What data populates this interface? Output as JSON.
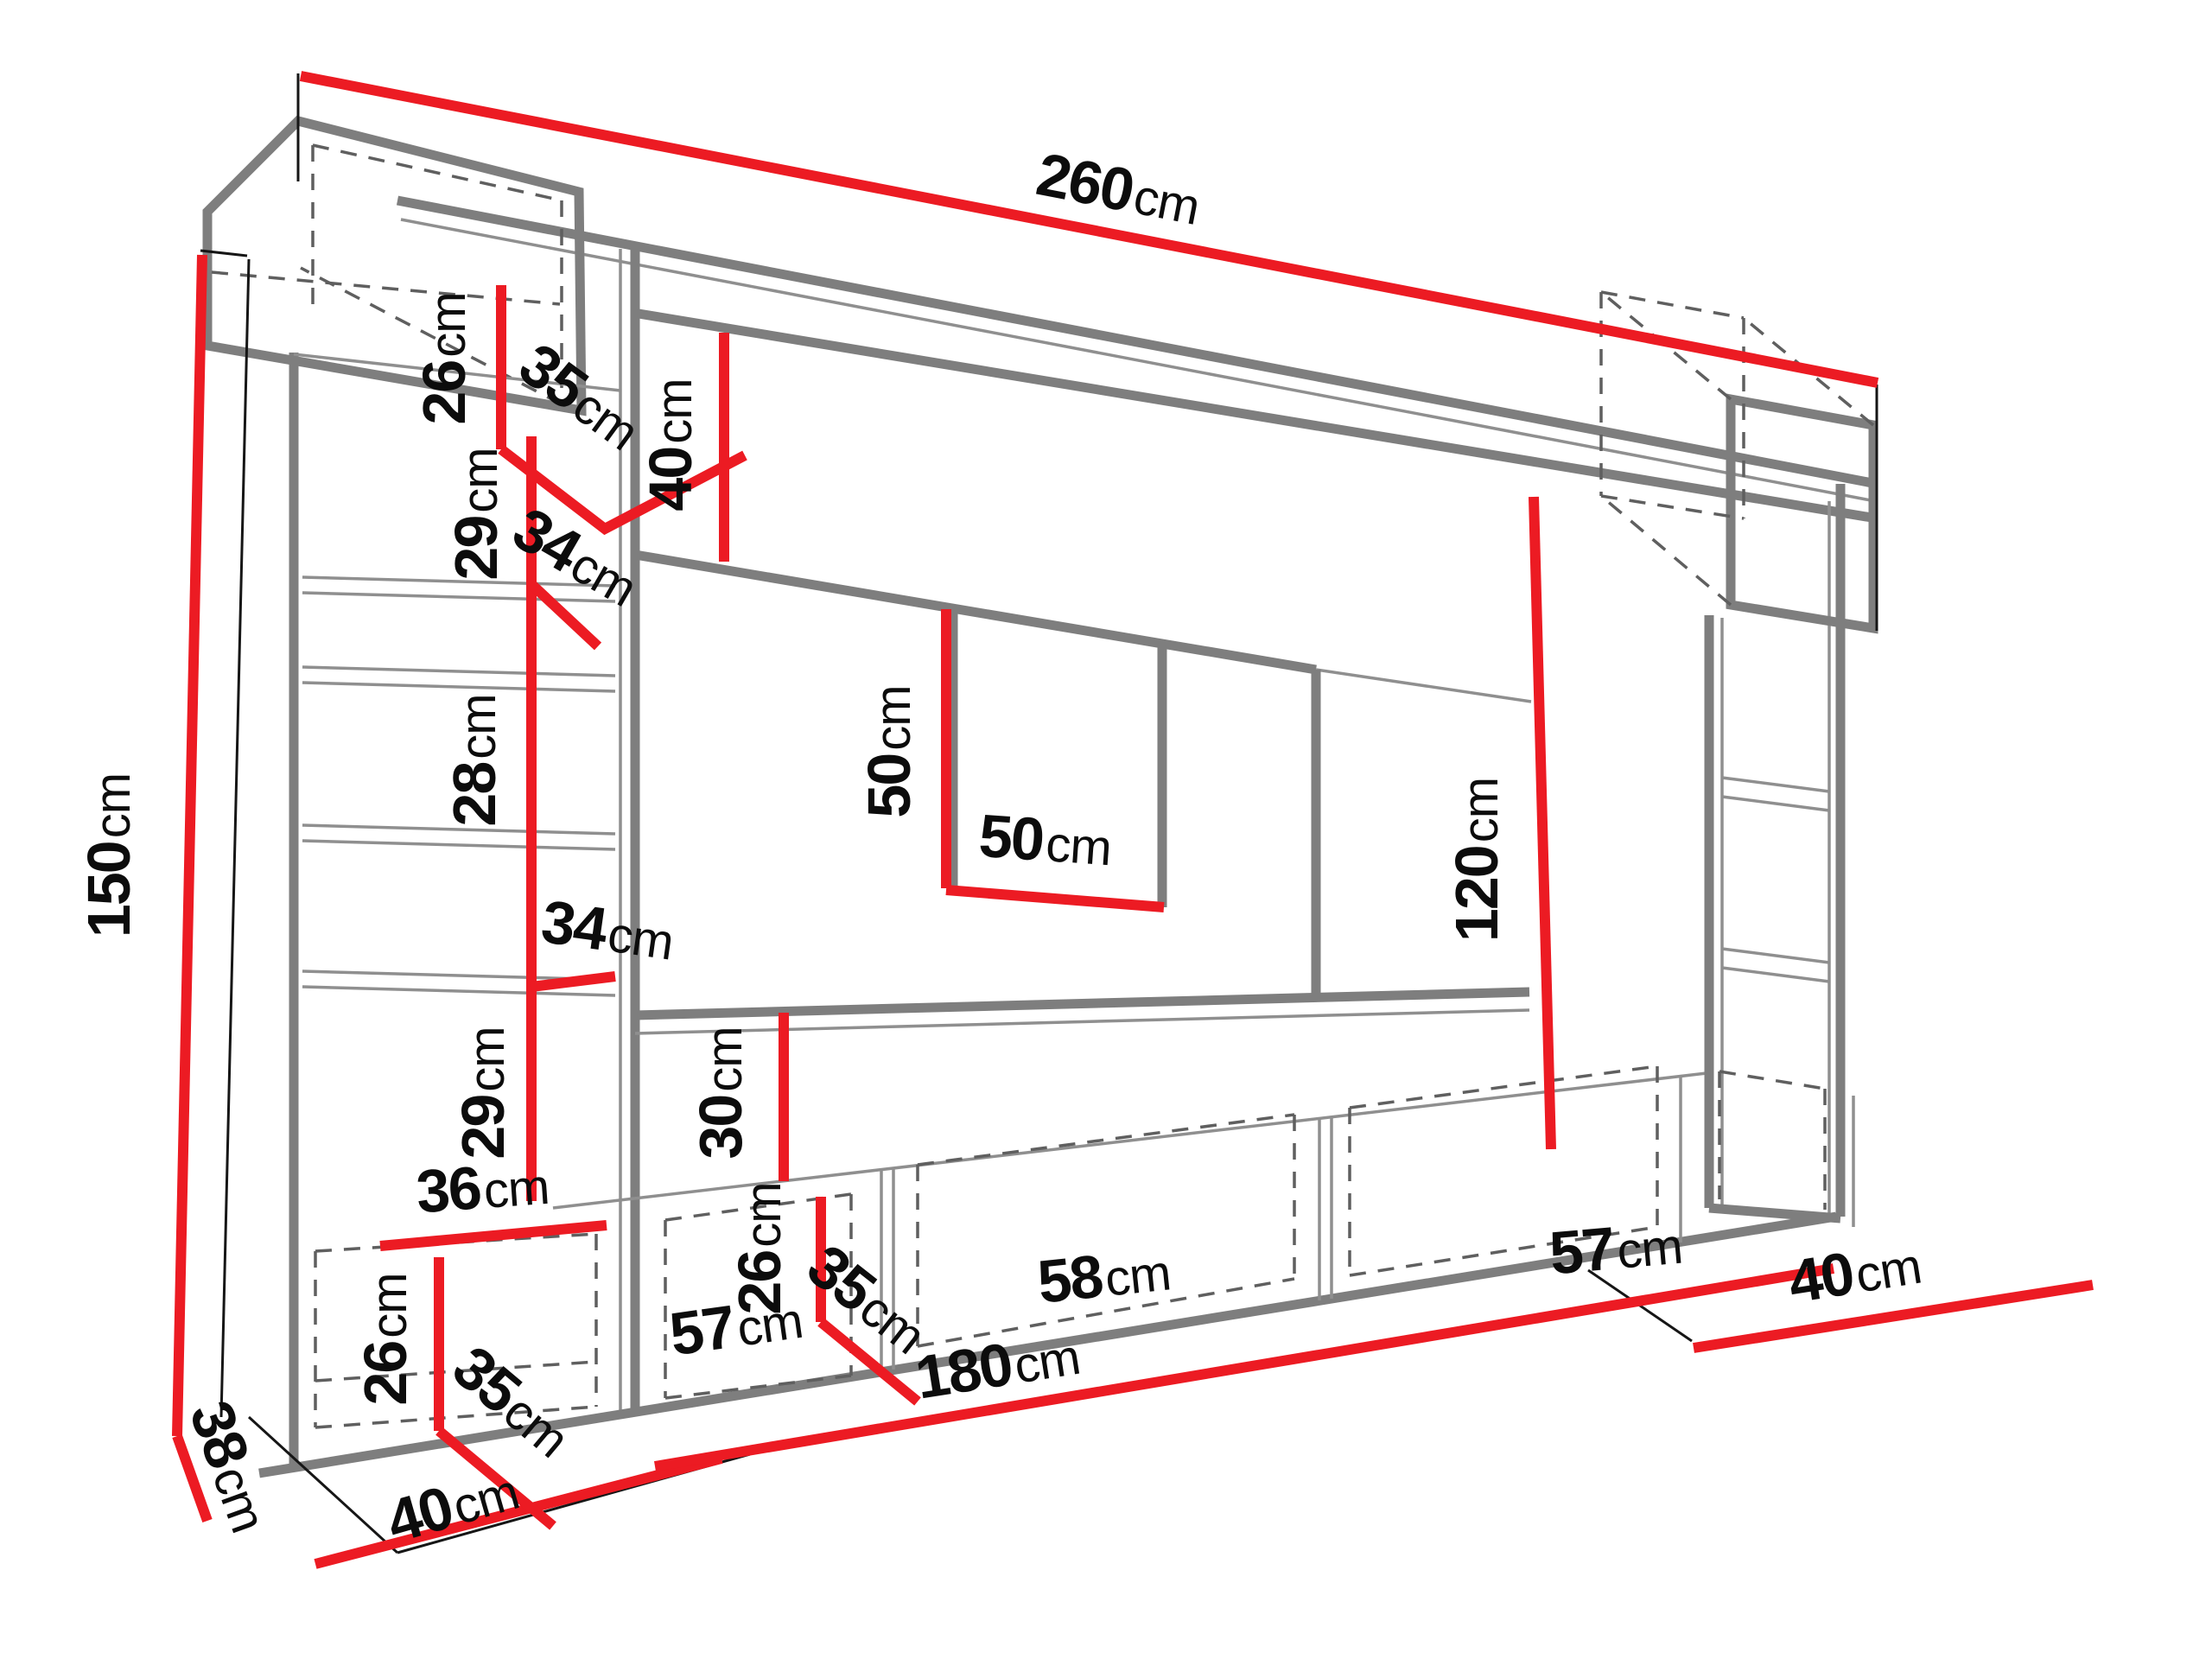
{
  "diagram": {
    "kind": "furniture dimension drawing",
    "unit_suffix": "cm",
    "colors": {
      "dimension_line": "#ec1b23",
      "furniture_line": "#7e7e7e",
      "hidden_line": "#5f5f5f",
      "label_text": "#0c0c0c",
      "background": "#ffffff"
    },
    "labels": [
      {
        "id": "overall-width",
        "num": "260",
        "unit": "cm"
      },
      {
        "id": "overall-height-left",
        "num": "150",
        "unit": "cm"
      },
      {
        "id": "topleft-cabinet-height",
        "num": "26",
        "unit": "cm"
      },
      {
        "id": "topleft-cabinet-depth",
        "num": "35",
        "unit": "cm"
      },
      {
        "id": "top-panel-height",
        "num": "40",
        "unit": "cm"
      },
      {
        "id": "left-column-section-1",
        "num": "29",
        "unit": "cm"
      },
      {
        "id": "left-column-gap-1",
        "num": "34",
        "unit": "cm"
      },
      {
        "id": "left-column-section-2",
        "num": "28",
        "unit": "cm"
      },
      {
        "id": "left-column-gap-2",
        "num": "34",
        "unit": "cm"
      },
      {
        "id": "left-column-section-3",
        "num": "29",
        "unit": "cm"
      },
      {
        "id": "left-column-width",
        "num": "36",
        "unit": "cm"
      },
      {
        "id": "left-base-height",
        "num": "26",
        "unit": "cm"
      },
      {
        "id": "left-base-depth",
        "num": "35",
        "unit": "cm"
      },
      {
        "id": "side-depth",
        "num": "38",
        "unit": "cm"
      },
      {
        "id": "base-left-width",
        "num": "40",
        "unit": "cm"
      },
      {
        "id": "tv-niche-height",
        "num": "50",
        "unit": "cm"
      },
      {
        "id": "tv-niche-width",
        "num": "50",
        "unit": "cm"
      },
      {
        "id": "middle-gap-height",
        "num": "30",
        "unit": "cm"
      },
      {
        "id": "right-column-height",
        "num": "120",
        "unit": "cm"
      },
      {
        "id": "middle-base-height",
        "num": "26",
        "unit": "cm"
      },
      {
        "id": "middle-base-depth",
        "num": "35",
        "unit": "cm"
      },
      {
        "id": "base-cabinet-1-width",
        "num": "57",
        "unit": "cm"
      },
      {
        "id": "base-cabinet-2-width",
        "num": "58",
        "unit": "cm"
      },
      {
        "id": "base-cabinet-3-width",
        "num": "57",
        "unit": "cm"
      },
      {
        "id": "base-total-width",
        "num": "180",
        "unit": "cm"
      },
      {
        "id": "base-right-depth",
        "num": "40",
        "unit": "cm"
      }
    ]
  }
}
